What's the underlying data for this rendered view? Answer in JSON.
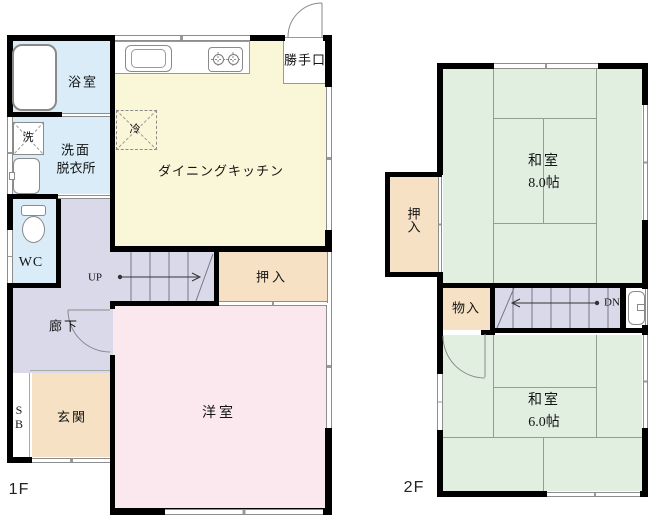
{
  "title": "house floor plan 1F / 2F",
  "colors": {
    "wall": "#000000",
    "water_room": "#d9ecf7",
    "hall_stairs": "#d9d9e9",
    "kitchen": "#faf6d8",
    "closet_tan": "#f6e1c4",
    "western_pink": "#fbe7ee",
    "tatami_green": "#e1efe1",
    "fixture_line": "#8d8d8d"
  },
  "floor1": {
    "label": "1F",
    "rooms": {
      "bath": "浴室",
      "washroom_line1": "洗面",
      "washroom_line2": "脱衣所",
      "laundry": "洗",
      "wc": "WC",
      "hallway": "廊下",
      "stairs_up": "UP",
      "closet": "押入",
      "entrance": "玄関",
      "shoe_box": "SB",
      "western_room": "洋室",
      "dining_kitchen": "ダイニングキッチン",
      "fridge": "冷",
      "back_door": "勝手口"
    }
  },
  "floor2": {
    "label": "2F",
    "rooms": {
      "tatami8_line1": "和室",
      "tatami8_line2": "8.0帖",
      "closet": "押入",
      "storage": "物入",
      "stairs_down": "DN",
      "tatami6_line1": "和室",
      "tatami6_line2": "6.0帖"
    }
  }
}
